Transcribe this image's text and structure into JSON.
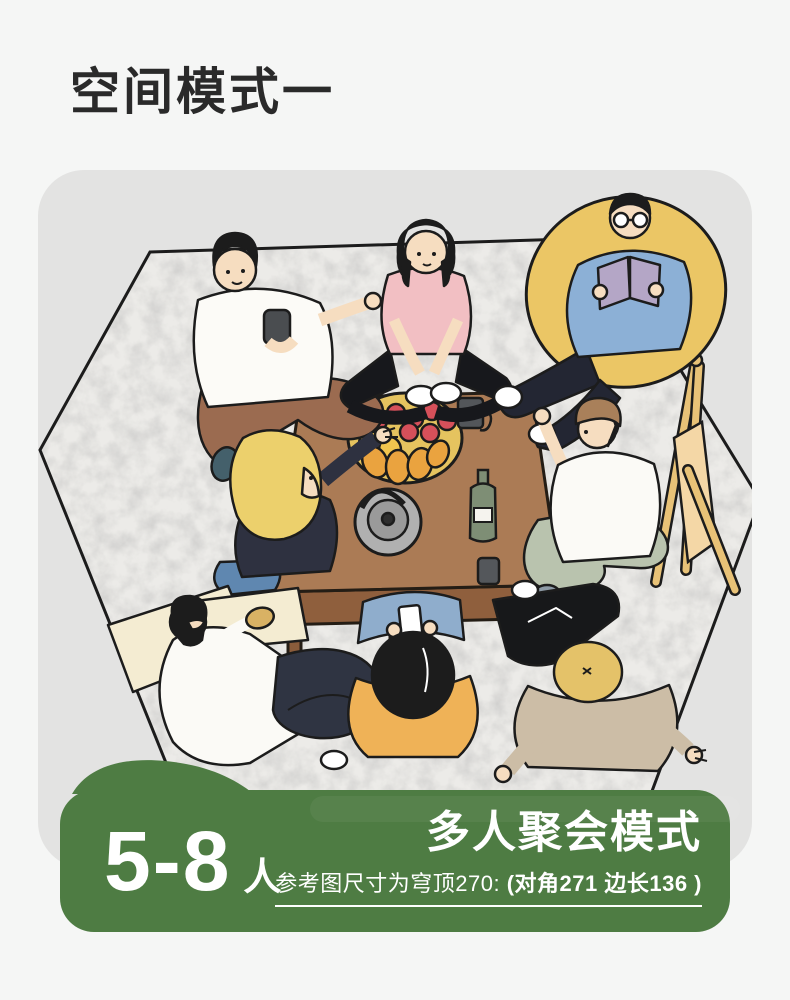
{
  "page": {
    "background_color": "#f5f6f5"
  },
  "header": {
    "title": "空间模式一"
  },
  "card": {
    "background_color": "#e3e3e2"
  },
  "illustration": {
    "name": "top-view-gathering-scene",
    "visible_elements": [
      "hexagonal-gray-mat",
      "low-wooden-table",
      "fruit-plate",
      "kettle",
      "wine-bottle",
      "mugs",
      "yellow-bean-bag",
      "wooden-folding-stand",
      "man-white-tee-brown-pants",
      "woman-pink-tee",
      "man-blue-jacket-reading",
      "man-brown-cap",
      "blonde-woman-reaching",
      "person-lying-on-pillow",
      "person-orange-shirt-phone",
      "person-beige-sweater"
    ]
  },
  "banner": {
    "background_color": "#4e7c43",
    "capacity_number": "5-8",
    "capacity_unit": "人",
    "mode_title": "多人聚会模式",
    "size_note_prefix": "参考图尺寸为穹顶270: ",
    "size_note_bold": "(对角271 边长136 )"
  }
}
